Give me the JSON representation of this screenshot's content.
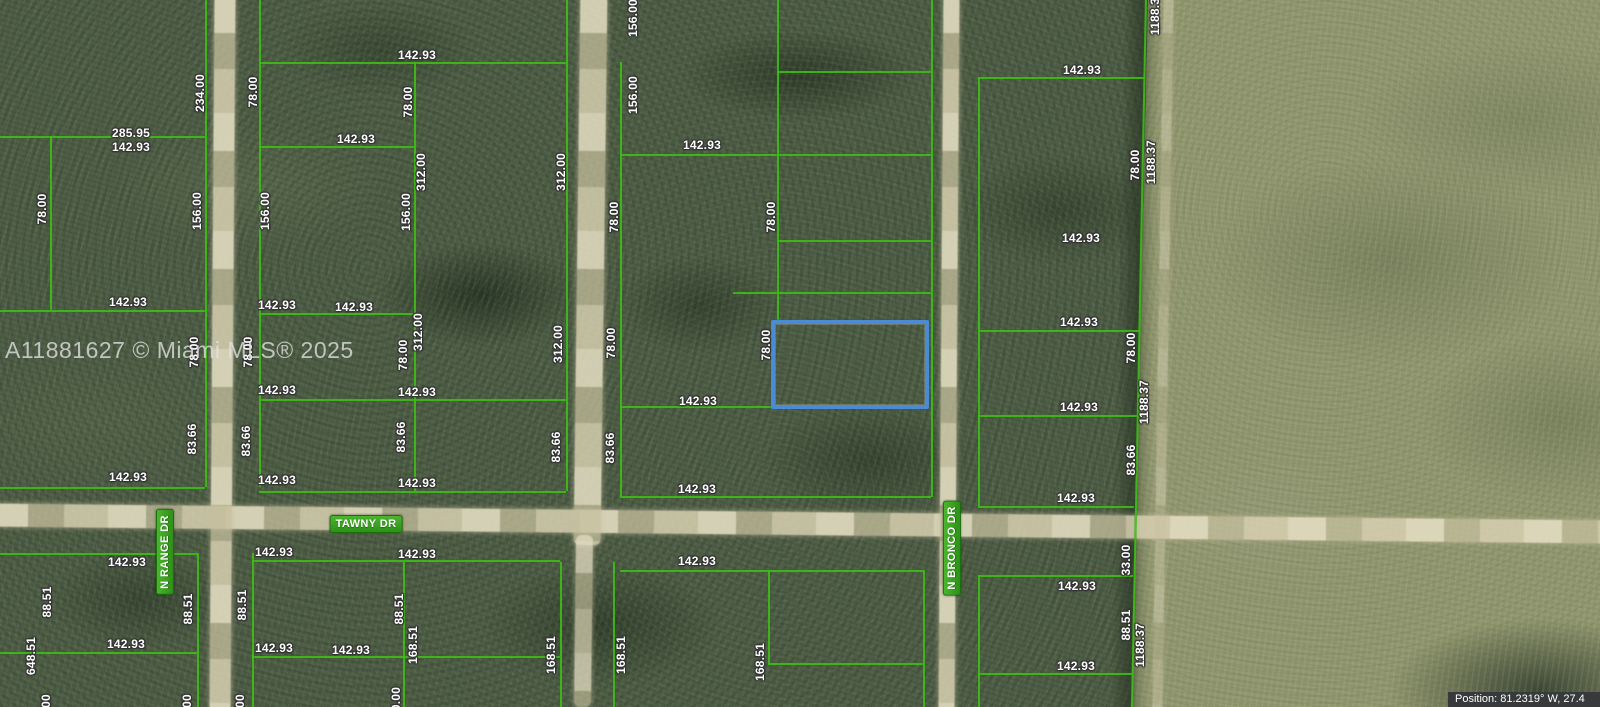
{
  "watermark": {
    "text": "A11881627 © Miami MLS® 2025"
  },
  "status_bar": {
    "text": "Position: 81.2319° W, 27.4"
  },
  "street_labels": [
    {
      "label": "TAWNY DR",
      "slug": "tawny-dr",
      "x": 366,
      "y": 524,
      "vertical": false
    },
    {
      "label": "N RANGE DR",
      "slug": "n-range-dr",
      "x": 165,
      "y": 552,
      "vertical": true
    },
    {
      "label": "N BRONCO DR",
      "slug": "n-bronco-dr",
      "x": 952,
      "y": 548,
      "vertical": true
    }
  ],
  "highlighted_parcel": {
    "x": 771,
    "y": 320,
    "w": 158,
    "h": 89
  },
  "dimension_labels": [
    {
      "t": "285.95",
      "x": 131,
      "y": 133,
      "v": 0
    },
    {
      "t": "142.93",
      "x": 131,
      "y": 147,
      "v": 0
    },
    {
      "t": "142.93",
      "x": 417,
      "y": 55,
      "v": 0
    },
    {
      "t": "142.93",
      "x": 356,
      "y": 139,
      "v": 0
    },
    {
      "t": "142.93",
      "x": 702,
      "y": 145,
      "v": 0
    },
    {
      "t": "142.93",
      "x": 1082,
      "y": 70,
      "v": 0
    },
    {
      "t": "142.93",
      "x": 128,
      "y": 302,
      "v": 0
    },
    {
      "t": "142.93",
      "x": 277,
      "y": 305,
      "v": 0
    },
    {
      "t": "142.93",
      "x": 354,
      "y": 307,
      "v": 0
    },
    {
      "t": "142.93",
      "x": 1081,
      "y": 238,
      "v": 0
    },
    {
      "t": "142.93",
      "x": 1079,
      "y": 322,
      "v": 0
    },
    {
      "t": "142.93",
      "x": 277,
      "y": 390,
      "v": 0
    },
    {
      "t": "142.93",
      "x": 417,
      "y": 392,
      "v": 0
    },
    {
      "t": "142.93",
      "x": 698,
      "y": 401,
      "v": 0
    },
    {
      "t": "142.93",
      "x": 1079,
      "y": 407,
      "v": 0
    },
    {
      "t": "142.93",
      "x": 128,
      "y": 477,
      "v": 0
    },
    {
      "t": "142.93",
      "x": 277,
      "y": 480,
      "v": 0
    },
    {
      "t": "142.93",
      "x": 417,
      "y": 483,
      "v": 0
    },
    {
      "t": "142.93",
      "x": 697,
      "y": 489,
      "v": 0
    },
    {
      "t": "142.93",
      "x": 1076,
      "y": 498,
      "v": 0
    },
    {
      "t": "142.93",
      "x": 127,
      "y": 562,
      "v": 0
    },
    {
      "t": "142.93",
      "x": 274,
      "y": 552,
      "v": 0
    },
    {
      "t": "142.93",
      "x": 417,
      "y": 554,
      "v": 0
    },
    {
      "t": "142.93",
      "x": 697,
      "y": 561,
      "v": 0
    },
    {
      "t": "142.93",
      "x": 1077,
      "y": 586,
      "v": 0
    },
    {
      "t": "142.93",
      "x": 126,
      "y": 644,
      "v": 0
    },
    {
      "t": "142.93",
      "x": 274,
      "y": 648,
      "v": 0
    },
    {
      "t": "142.93",
      "x": 351,
      "y": 650,
      "v": 0
    },
    {
      "t": "142.93",
      "x": 1076,
      "y": 666,
      "v": 0
    },
    {
      "t": "234.00",
      "x": 200,
      "y": 93,
      "v": 1
    },
    {
      "t": "78.00",
      "x": 253,
      "y": 92,
      "v": 1
    },
    {
      "t": "78.00",
      "x": 42,
      "y": 209,
      "v": 1
    },
    {
      "t": "156.00",
      "x": 197,
      "y": 211,
      "v": 1
    },
    {
      "t": "156.00",
      "x": 265,
      "y": 211,
      "v": 1
    },
    {
      "t": "78.00",
      "x": 408,
      "y": 102,
      "v": 1
    },
    {
      "t": "312.00",
      "x": 421,
      "y": 172,
      "v": 1
    },
    {
      "t": "156.00",
      "x": 406,
      "y": 212,
      "v": 1
    },
    {
      "t": "312.00",
      "x": 561,
      "y": 172,
      "v": 1
    },
    {
      "t": "156.00",
      "x": 633,
      "y": 18,
      "v": 1
    },
    {
      "t": "156.00",
      "x": 633,
      "y": 95,
      "v": 1
    },
    {
      "t": "78.00",
      "x": 614,
      "y": 217,
      "v": 1
    },
    {
      "t": "78.00",
      "x": 771,
      "y": 217,
      "v": 1
    },
    {
      "t": "1188.37",
      "x": 1155,
      "y": 13,
      "v": 1
    },
    {
      "t": "78.00",
      "x": 1135,
      "y": 165,
      "v": 1
    },
    {
      "t": "1188.37",
      "x": 1151,
      "y": 162,
      "v": 1
    },
    {
      "t": "78.00",
      "x": 194,
      "y": 352,
      "v": 1
    },
    {
      "t": "78.00",
      "x": 248,
      "y": 352,
      "v": 1
    },
    {
      "t": "312.00",
      "x": 418,
      "y": 332,
      "v": 1
    },
    {
      "t": "78.00",
      "x": 403,
      "y": 355,
      "v": 1
    },
    {
      "t": "312.00",
      "x": 558,
      "y": 344,
      "v": 1
    },
    {
      "t": "78.00",
      "x": 611,
      "y": 343,
      "v": 1
    },
    {
      "t": "78.00",
      "x": 766,
      "y": 345,
      "v": 1
    },
    {
      "t": "78.00",
      "x": 1131,
      "y": 348,
      "v": 1
    },
    {
      "t": "1188.37",
      "x": 1144,
      "y": 402,
      "v": 1
    },
    {
      "t": "83.66",
      "x": 192,
      "y": 439,
      "v": 1
    },
    {
      "t": "83.66",
      "x": 246,
      "y": 441,
      "v": 1
    },
    {
      "t": "83.66",
      "x": 401,
      "y": 437,
      "v": 1
    },
    {
      "t": "83.66",
      "x": 556,
      "y": 447,
      "v": 1
    },
    {
      "t": "83.66",
      "x": 610,
      "y": 448,
      "v": 1
    },
    {
      "t": "83.66",
      "x": 1131,
      "y": 460,
      "v": 1
    },
    {
      "t": "33.00",
      "x": 1126,
      "y": 560,
      "v": 1
    },
    {
      "t": "88.51",
      "x": 47,
      "y": 602,
      "v": 1
    },
    {
      "t": "88.51",
      "x": 188,
      "y": 609,
      "v": 1
    },
    {
      "t": "88.51",
      "x": 242,
      "y": 605,
      "v": 1
    },
    {
      "t": "88.51",
      "x": 399,
      "y": 609,
      "v": 1
    },
    {
      "t": "88.51",
      "x": 1126,
      "y": 625,
      "v": 1
    },
    {
      "t": "648.51",
      "x": 31,
      "y": 656,
      "v": 1
    },
    {
      "t": "168.51",
      "x": 413,
      "y": 645,
      "v": 1
    },
    {
      "t": "168.51",
      "x": 551,
      "y": 655,
      "v": 1
    },
    {
      "t": "168.51",
      "x": 621,
      "y": 655,
      "v": 1
    },
    {
      "t": "168.51",
      "x": 760,
      "y": 662,
      "v": 1
    },
    {
      "t": "1188.37",
      "x": 1140,
      "y": 645,
      "v": 1
    },
    {
      "t": "00",
      "x": 46,
      "y": 701,
      "v": 1
    },
    {
      "t": "00",
      "x": 187,
      "y": 701,
      "v": 1
    },
    {
      "t": "00",
      "x": 240,
      "y": 701,
      "v": 1
    },
    {
      "t": "0.00",
      "x": 396,
      "y": 699,
      "v": 1
    }
  ],
  "parcel_grid": {
    "h_lines": [
      {
        "y": 62,
        "x1": 259,
        "x2": 566
      },
      {
        "y": 71,
        "x1": 777,
        "x2": 931
      },
      {
        "y": 77,
        "x1": 978,
        "x2": 1145
      },
      {
        "y": 136,
        "x1": 0,
        "x2": 205
      },
      {
        "y": 146,
        "x1": 259,
        "x2": 414
      },
      {
        "y": 154,
        "x1": 620,
        "x2": 931
      },
      {
        "y": 240,
        "x1": 777,
        "x2": 931
      },
      {
        "y": 292,
        "x1": 733,
        "x2": 931
      },
      {
        "y": 310,
        "x1": 0,
        "x2": 205
      },
      {
        "y": 313,
        "x1": 259,
        "x2": 414
      },
      {
        "y": 330,
        "x1": 978,
        "x2": 1140
      },
      {
        "y": 399,
        "x1": 259,
        "x2": 566
      },
      {
        "y": 406,
        "x1": 620,
        "x2": 773
      },
      {
        "y": 415,
        "x1": 978,
        "x2": 1139
      },
      {
        "y": 487,
        "x1": 0,
        "x2": 205
      },
      {
        "y": 491,
        "x1": 259,
        "x2": 566
      },
      {
        "y": 496,
        "x1": 620,
        "x2": 931
      },
      {
        "y": 506,
        "x1": 978,
        "x2": 1134
      },
      {
        "y": 553,
        "x1": 0,
        "x2": 197
      },
      {
        "y": 560,
        "x1": 252,
        "x2": 560
      },
      {
        "y": 570,
        "x1": 620,
        "x2": 923
      },
      {
        "y": 575,
        "x1": 978,
        "x2": 1133
      },
      {
        "y": 652,
        "x1": 0,
        "x2": 197
      },
      {
        "y": 656,
        "x1": 252,
        "x2": 560
      },
      {
        "y": 663,
        "x1": 768,
        "x2": 923
      },
      {
        "y": 673,
        "x1": 978,
        "x2": 1133
      }
    ],
    "v_lines": [
      {
        "x": 50,
        "y1": 136,
        "y2": 310
      },
      {
        "x": 205,
        "y1": 0,
        "y2": 487
      },
      {
        "x": 197,
        "y1": 553,
        "y2": 707
      },
      {
        "x": 259,
        "y1": 0,
        "y2": 487
      },
      {
        "x": 252,
        "y1": 553,
        "y2": 707
      },
      {
        "x": 414,
        "y1": 62,
        "y2": 491
      },
      {
        "x": 403,
        "y1": 562,
        "y2": 707
      },
      {
        "x": 566,
        "y1": 0,
        "y2": 491
      },
      {
        "x": 560,
        "y1": 562,
        "y2": 707
      },
      {
        "x": 620,
        "y1": 62,
        "y2": 496
      },
      {
        "x": 613,
        "y1": 562,
        "y2": 707
      },
      {
        "x": 777,
        "y1": 0,
        "y2": 323
      },
      {
        "x": 931,
        "y1": 0,
        "y2": 497
      },
      {
        "x": 768,
        "y1": 570,
        "y2": 665
      },
      {
        "x": 923,
        "y1": 570,
        "y2": 707
      },
      {
        "x": 978,
        "y1": 77,
        "y2": 506
      },
      {
        "x": 978,
        "y1": 575,
        "y2": 707
      },
      {
        "x": 1138,
        "y1": -5,
        "y2": 712,
        "rot": 1.13
      }
    ]
  },
  "roads": [
    {
      "name": "tawny-dr-road",
      "cls": "road-h",
      "x": -10,
      "y": 512,
      "w": 1620,
      "h": 23,
      "rot": 0.6,
      "opacity": 0.95
    },
    {
      "name": "n-range-dr-road",
      "cls": "road-v",
      "x": 212,
      "y": -5,
      "w": 21,
      "h": 717,
      "rot": 0.4,
      "opacity": 0.95
    },
    {
      "name": "center-road-north",
      "cls": "road-v",
      "x": 577,
      "y": -5,
      "w": 27,
      "h": 550,
      "rot": 0.7,
      "opacity": 0.92
    },
    {
      "name": "center-trail-south",
      "cls": "road-v",
      "x": 575,
      "y": 535,
      "w": 17,
      "h": 172,
      "rot": 0.7,
      "opacity": 0.8
    },
    {
      "name": "n-bronco-dr-road",
      "cls": "road-v",
      "x": 941,
      "y": -5,
      "w": 16,
      "h": 717,
      "rot": 0.4,
      "opacity": 0.95
    },
    {
      "name": "field-trail",
      "cls": "road-v",
      "x": 1158,
      "y": -5,
      "w": 10,
      "h": 717,
      "rot": 0.9,
      "opacity": 0.45
    }
  ],
  "colors": {
    "parcel_line_green": "#3fbf17",
    "highlight_blue": "#4a8bd3",
    "street_badge_green": "#2e9018",
    "road_tan": "#cdc6a4",
    "forest_base": "#4d5c45",
    "field_base": "#91976e",
    "watermark_gray": "#e2e2e2",
    "position_bar_bg": "#37393b"
  }
}
